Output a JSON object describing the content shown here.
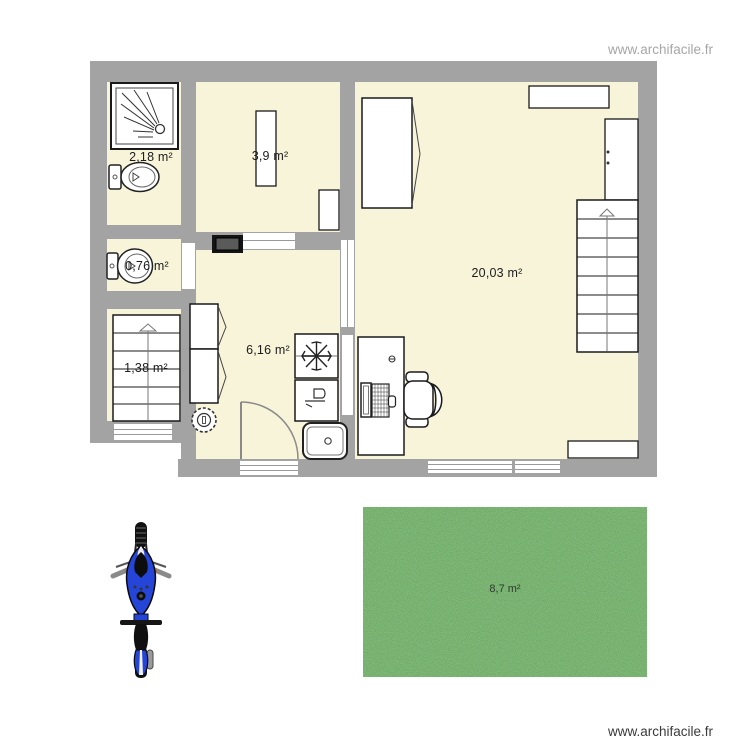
{
  "plan": {
    "title": "floor-plan",
    "watermarks": {
      "top_right": "www.archifacile.fr",
      "bottom_right": "www.archifacile.fr"
    },
    "rooms": {
      "bathroom": {
        "label": "2,18 m²"
      },
      "bedroom": {
        "label": "3,9 m²"
      },
      "wc": {
        "label": "0,76 m²"
      },
      "stairwell": {
        "label": "1,38 m²"
      },
      "kitchen": {
        "label": "6,16 m²"
      },
      "living": {
        "label": "20,03 m²"
      },
      "garden": {
        "label": "8,7 m²"
      }
    },
    "fixtures": [
      "shower",
      "toilet",
      "toilet",
      "stairs",
      "stairs",
      "stove",
      "cupboard",
      "fridge-freezer",
      "dishwasher",
      "kitchen-sink",
      "washing-machine",
      "door-swing",
      "desk",
      "computer",
      "office-chair",
      "wardrobe",
      "wardrobe",
      "shelf",
      "shelf",
      "radiator",
      "motorcycle",
      "grass-area"
    ],
    "colors": {
      "wall": "#a3a3a3",
      "floor": "#f8f4da",
      "grass": "#579a4f",
      "motorcycle_blue": "#2545d9",
      "fixture_outline": "#1a1a1a"
    }
  }
}
